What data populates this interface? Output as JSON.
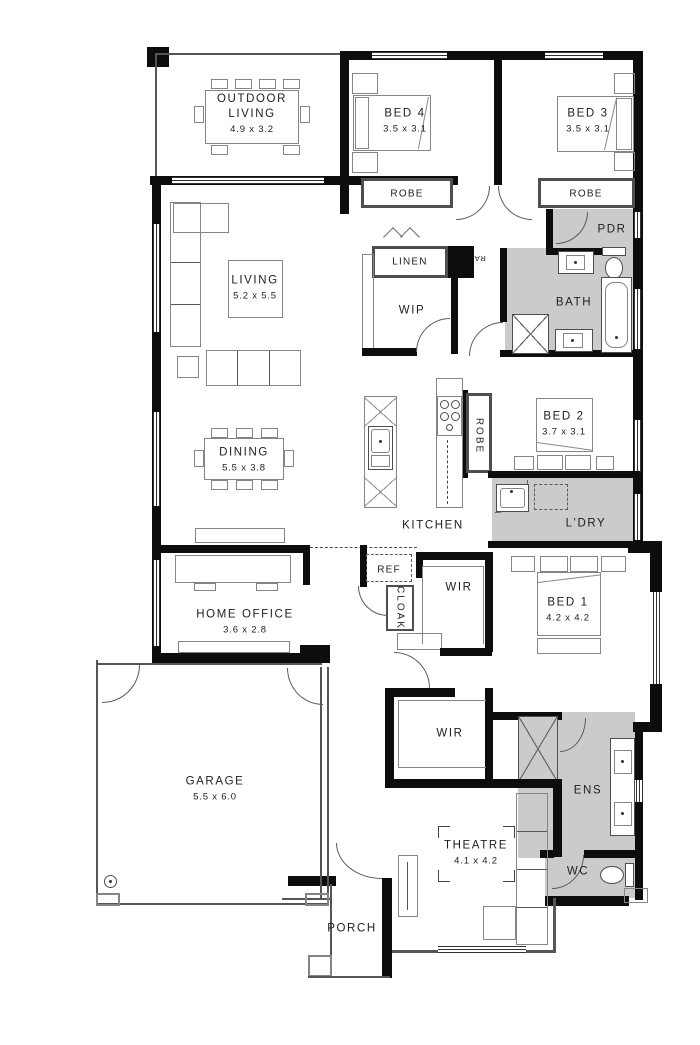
{
  "rooms": {
    "outdoor_living": {
      "name": "OUTDOOR LIVING",
      "dims": "4.9 x 3.2"
    },
    "bed4": {
      "name": "BED 4",
      "dims": "3.5 x 3.1"
    },
    "bed3": {
      "name": "BED 3",
      "dims": "3.5 x 3.1"
    },
    "robe_bed4": {
      "name": "ROBE"
    },
    "robe_bed3": {
      "name": "ROBE"
    },
    "pdr": {
      "name": "PDR"
    },
    "linen": {
      "name": "LINEN"
    },
    "wip": {
      "name": "WIP"
    },
    "bath": {
      "name": "BATH"
    },
    "bed2": {
      "name": "BED 2",
      "dims": "3.7 x 3.1"
    },
    "robe_hall": {
      "name": "ROBE"
    },
    "living": {
      "name": "LIVING",
      "dims": "5.2 x 5.5"
    },
    "dining": {
      "name": "DINING",
      "dims": "5.5 x 3.8"
    },
    "kitchen": {
      "name": "KITCHEN"
    },
    "ldry": {
      "name": "L'DRY"
    },
    "ref": {
      "name": "REF"
    },
    "cloak": {
      "name": "CLOAK"
    },
    "home_office": {
      "name": "HOME OFFICE",
      "dims": "3.6 x 2.8"
    },
    "wir_upper": {
      "name": "WIR"
    },
    "bed1": {
      "name": "BED 1",
      "dims": "4.2 x 4.2"
    },
    "garage": {
      "name": "GARAGE",
      "dims": "5.5 x 6.0"
    },
    "wir_lower": {
      "name": "WIR"
    },
    "ens": {
      "name": "ENS"
    },
    "theatre": {
      "name": "THEATRE",
      "dims": "4.1 x 4.2"
    },
    "wc": {
      "name": "WC"
    },
    "porch": {
      "name": "PORCH"
    },
    "ra_vent": {
      "name": "RA"
    }
  },
  "colors": {
    "wall": "#0d0d0d",
    "wet_area": "#cbcbcb",
    "furniture_line": "#858585"
  }
}
